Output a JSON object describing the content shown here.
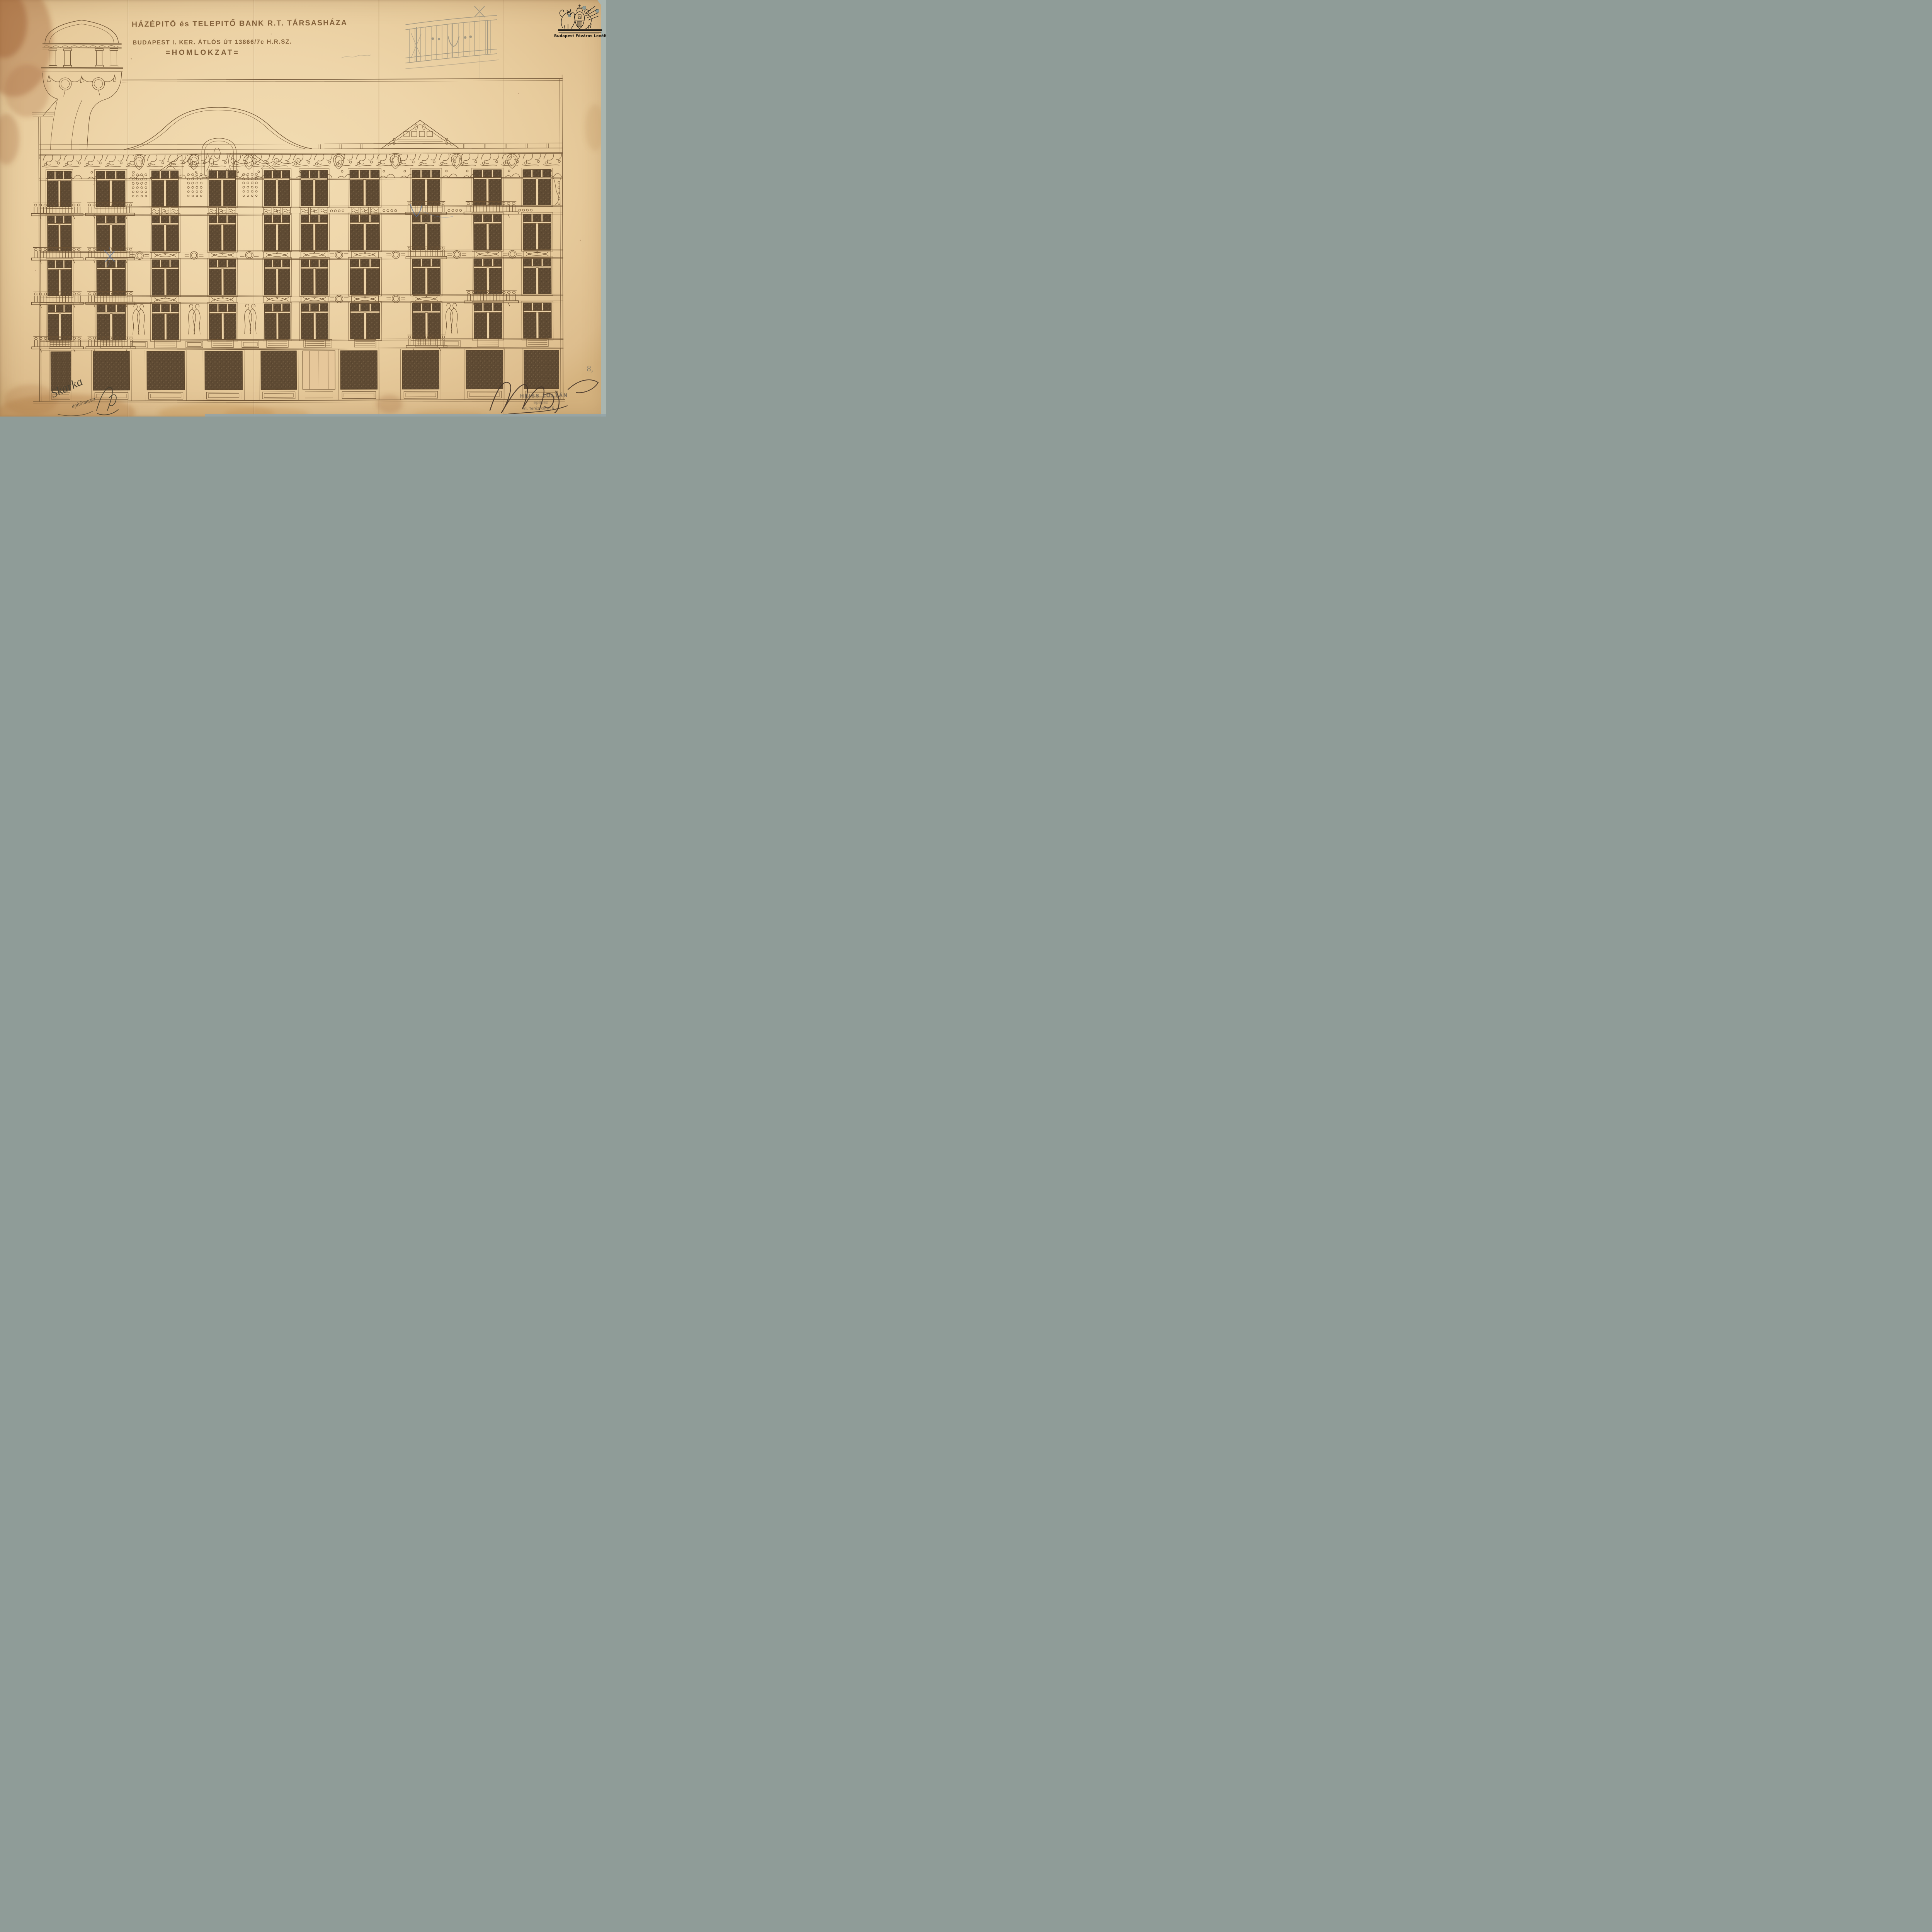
{
  "document": {
    "title_line1": "HÁZÉPITŐ és TELEPITŐ BANK R.T. TÁRSASHÁZA",
    "title_line2": "BUDAPEST I. KER. ÁTLÓS ÚT 13866/7c H.R.SZ.",
    "subtitle": "=HOMLOKZAT=",
    "page_number": "8,"
  },
  "archive_stamp": {
    "caption": "Budapest Főváros Levéltára",
    "emblem": "coat-of-arms-lion-and-griffin-with-crowned-shield"
  },
  "architect_stamp": {
    "name": "HEISS ZOLTÁN",
    "title": "építész",
    "address": "VI. Teréz-körut 6."
  },
  "signatures": {
    "builder_name": "Skarka",
    "builder_title": "építőmester"
  },
  "colors": {
    "paper": "#eed5a9",
    "ink": "#6d5233",
    "window_glass": "#5c4833",
    "stain": "#a5693f",
    "pencil": "#97907e",
    "blue_pencil": "#5a74a0",
    "stamp_gray": "#6b6053",
    "emblem_black": "#1c1a17",
    "scan_edge": "#a9b5af"
  }
}
